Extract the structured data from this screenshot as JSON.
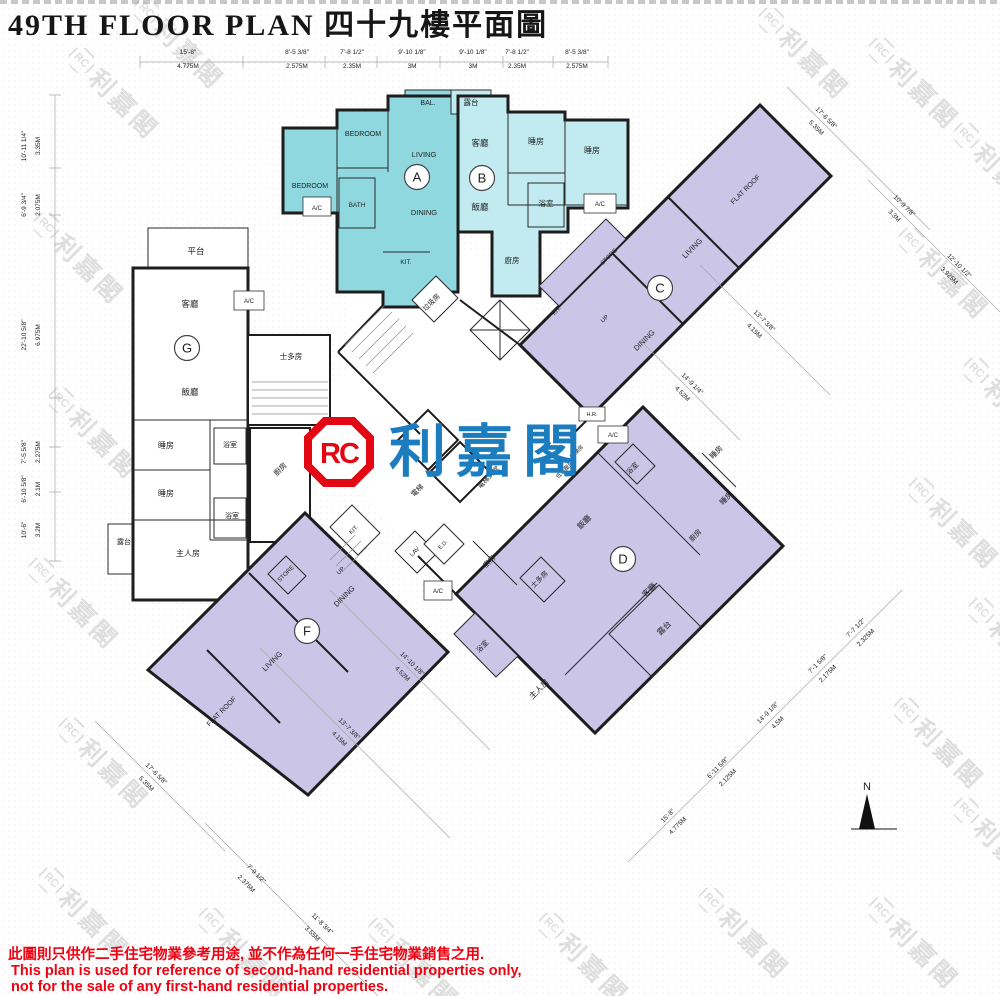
{
  "title": "49TH FLOOR PLAN 四十九樓平面圖",
  "logo": {
    "monogram": "RC",
    "name": "利嘉閣"
  },
  "watermark": {
    "monogram": "RC",
    "name": "利嘉閣"
  },
  "compass": {
    "label": "N"
  },
  "units": {
    "A": {
      "letter": "A",
      "rooms": {
        "bedroom1": "BEDROOM",
        "bedroom2": "BEDROOM",
        "living": "LIVING",
        "dining": "DINING",
        "bath": "BATH",
        "kit": "KIT.",
        "bal": "BAL.",
        "ac": "A/C"
      }
    },
    "B": {
      "letter": "B",
      "rooms": {
        "balcony": "露台",
        "living": "客廳",
        "dining": "飯廳",
        "bed1": "睡房",
        "bed2": "睡房",
        "bath": "浴室",
        "kitchen": "廚房",
        "ac": "A/C"
      }
    },
    "C": {
      "letter": "C",
      "rooms": {
        "living": "LIVING",
        "dining": "DINING",
        "flatroof": "FLAT ROOF",
        "kit": "KIT.",
        "store": "STORE",
        "up": "UP"
      }
    },
    "D": {
      "letter": "D",
      "rooms": {
        "dining": "飯廳",
        "living": "客廳",
        "bed1": "睡房",
        "bed2": "睡房",
        "kitchen1": "廚房",
        "kitchen2": "廚房",
        "store": "士多房",
        "master": "主人房",
        "bath1": "浴室",
        "bath2": "浴室",
        "balcony": "露台"
      }
    },
    "F": {
      "letter": "F",
      "rooms": {
        "dining": "DINING",
        "living": "LIVING",
        "flatroof": "FLAT ROOF",
        "store": "STORE",
        "up": "UP",
        "kit": "KIT.",
        "lav": "LAV",
        "ed": "E.D.",
        "ac": "A/C"
      }
    },
    "G": {
      "letter": "G",
      "rooms": {
        "terrace": "平台",
        "living": "客廳",
        "dining": "飯廳",
        "bed1": "睡房",
        "bed2": "睡房",
        "bath1": "浴室",
        "bath2": "浴室",
        "master": "主人房",
        "balcony": "露台",
        "store": "士多房",
        "kitchen": "廚房",
        "ac": "A/C"
      }
    }
  },
  "core": {
    "refuse": "垃圾房",
    "lift": "電梯",
    "lift_lobby": "電梯大堂",
    "lift_room": "電梯房",
    "lv_room": "低電壓房",
    "hr": "H.R.",
    "ac": "A/C"
  },
  "dimensions": {
    "top": [
      {
        "ft": "15'-8\"",
        "m": "4.775M"
      },
      {
        "ft": "8'-5 3/8\"",
        "m": "2.575M"
      },
      {
        "ft": "7'-8 1/2\"",
        "m": "2.35M"
      },
      {
        "ft": "9'-10 1/8\"",
        "m": "3M"
      },
      {
        "ft": "9'-10 1/8\"",
        "m": "3M"
      },
      {
        "ft": "7'-8 1/2\"",
        "m": "2.35M"
      },
      {
        "ft": "8'-5 3/8\"",
        "m": "2.575M"
      }
    ],
    "left": [
      {
        "ft": "10'-11 1/4\"",
        "m": "3.35M"
      },
      {
        "ft": "6'-9 3/4\"",
        "m": "2.075M"
      },
      {
        "ft": "22'-10 5/8\"",
        "m": "6.975M"
      },
      {
        "ft": "7'-5 5/8\"",
        "m": "2.275M"
      },
      {
        "ft": "6'-10 5/8\"",
        "m": "2.1M"
      },
      {
        "ft": "10'-6\"",
        "m": "3.2M"
      }
    ],
    "right": [
      {
        "ft": "17'-6 5/8\"",
        "m": "5.35M"
      },
      {
        "ft": "10'-9 7/8\"",
        "m": "3.3M"
      },
      {
        "ft": "12'-10 1/2\"",
        "m": "3.925M"
      },
      {
        "ft": "13'-7 3/8\"",
        "m": "4.15M"
      },
      {
        "ft": "14'-9 1/4\"",
        "m": "4.52M"
      }
    ],
    "bottom": [
      {
        "ft": "17'-6 5/8\"",
        "m": "5.35M"
      },
      {
        "ft": "13'-7 3/8\"",
        "m": "4.15M"
      },
      {
        "ft": "14'-10 1/8\"",
        "m": "4.52M"
      },
      {
        "ft": "7'-9 1/2\"",
        "m": "2.375M"
      },
      {
        "ft": "11'-8 3/4\"",
        "m": "3.55M"
      },
      {
        "ft": "15'-8\"",
        "m": "4.775M"
      },
      {
        "ft": "6'-11 5/8\"",
        "m": "2.125M"
      },
      {
        "ft": "14'-9 1/8\"",
        "m": "4.5M"
      },
      {
        "ft": "7'-1 5/8\"",
        "m": "2.175M"
      },
      {
        "ft": "7'-7 1/2\"",
        "m": "2.325M"
      }
    ]
  },
  "disclaimer": {
    "zh": "此圖則只供作二手住宅物業參考用途, 並不作為任何一手住宅物業銷售之用.",
    "en1": "This plan is used for reference of second-hand residential properties only,",
    "en2": "not for the sale of any first-hand residential properties."
  }
}
